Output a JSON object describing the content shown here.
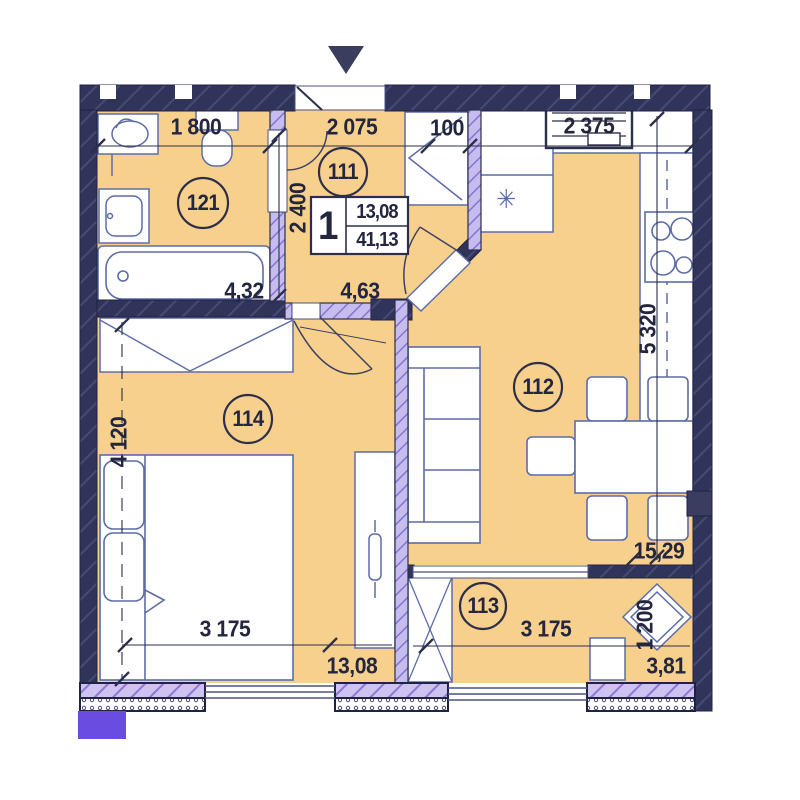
{
  "plan": {
    "unit": {
      "number": "1",
      "living_area": "13,08",
      "total_area": "41,13"
    },
    "rooms": {
      "bathroom": {
        "num": "121",
        "area": "4,32"
      },
      "hallway": {
        "num": "111",
        "area": "4,63"
      },
      "living_kitchen": {
        "num": "112",
        "area": "15,29"
      },
      "bedroom": {
        "num": "114",
        "area": "13,08"
      },
      "balcony": {
        "num": "113",
        "area": "3,81"
      }
    },
    "dims": {
      "top_bath": "1 800",
      "top_hall": "2 075",
      "top_gap": "100",
      "top_kitchen": "2 375",
      "hall_h": "2 400",
      "kitchen_h": "5 320",
      "bedroom_h": "4 120",
      "bedroom_w": "3 175",
      "balcony_w": "3 175",
      "balcony_h": "1 200"
    },
    "symbols": {
      "vent": "✳"
    },
    "colors": {
      "room_fill": "#f8d08d",
      "wall": "#31345a",
      "partition": "#c6bdee",
      "accent_purple": "#6a4de0",
      "line_blue": "#5d6ca8"
    }
  }
}
